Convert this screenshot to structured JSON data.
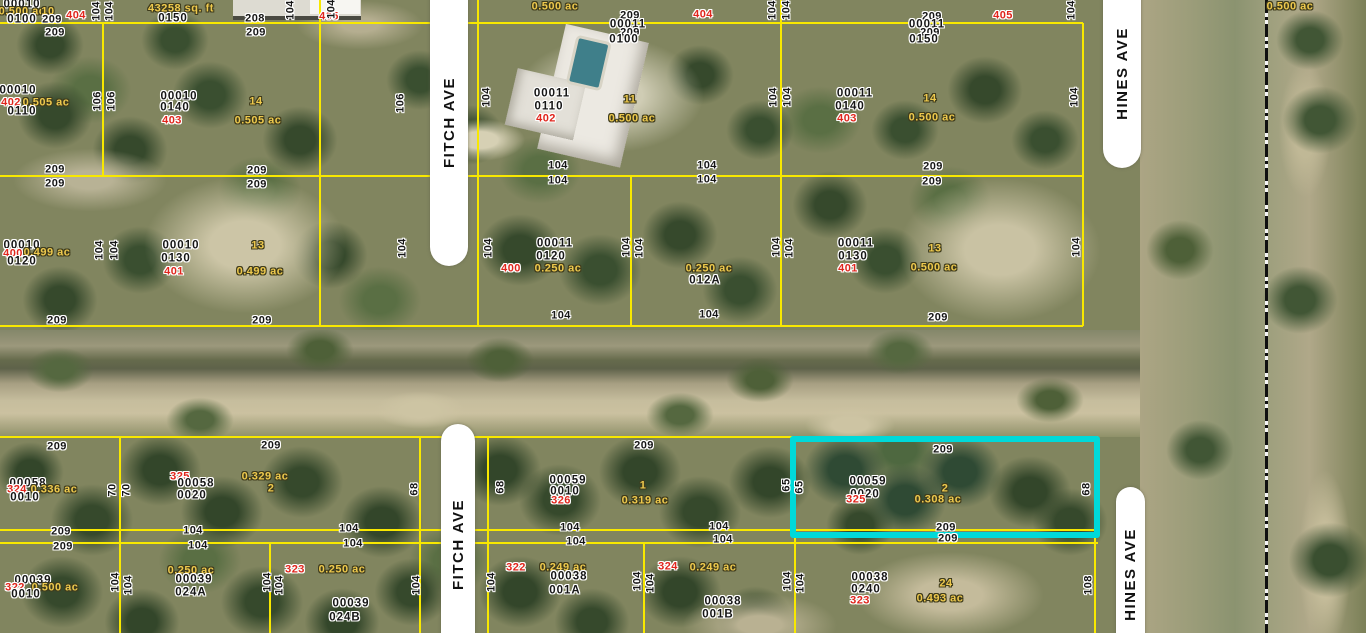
{
  "roads": [
    {
      "label": "FITCH AVE"
    },
    {
      "label": "FITCH AVE"
    },
    {
      "label": "HINES AVE"
    },
    {
      "label": "HINES AVE"
    }
  ],
  "colors": {
    "parcel_line": "#f8e800",
    "highlight": "#00d9d9",
    "house_number_text": "#e0251c",
    "lot_area_text": "#eec94d",
    "parcel_id_text": "#161616",
    "road_fill": "#ffffff"
  },
  "highlighted_parcel": {
    "parcel_id": "00059 0020",
    "lot": "2",
    "area": "0.308 ac",
    "house_number": "325",
    "frontage": "209",
    "depth": "65"
  },
  "labels": [
    [
      "00010",
      "pid",
      22,
      5,
      0
    ],
    [
      "0.500 ac",
      "yel",
      22,
      12,
      0
    ],
    [
      "10",
      "yel",
      48,
      12,
      0
    ],
    [
      "0100",
      "pid",
      22,
      20,
      0
    ],
    [
      "209",
      "dim",
      52,
      20,
      0
    ],
    [
      "404",
      "red",
      76,
      16,
      0
    ],
    [
      "104",
      "dim",
      97,
      11,
      1
    ],
    [
      "104",
      "dim",
      110,
      11,
      1
    ],
    [
      "43258 sq. ft",
      "yel",
      181,
      9,
      0
    ],
    [
      "0150",
      "pid",
      173,
      19,
      0
    ],
    [
      "208",
      "dim",
      255,
      19,
      0
    ],
    [
      "405",
      "red",
      329,
      17,
      0
    ],
    [
      "104",
      "dim",
      291,
      10,
      1
    ],
    [
      "104",
      "dim",
      332,
      9,
      1
    ],
    [
      "0.500 ac",
      "yel",
      555,
      7,
      0
    ],
    [
      "209",
      "dim",
      630,
      16,
      0
    ],
    [
      "00011",
      "pid",
      628,
      25,
      0
    ],
    [
      "209",
      "dim",
      630,
      33,
      0
    ],
    [
      "0100",
      "pid",
      624,
      40,
      0
    ],
    [
      "404",
      "red",
      703,
      15,
      0
    ],
    [
      "104",
      "dim",
      773,
      10,
      1
    ],
    [
      "104",
      "dim",
      787,
      10,
      1
    ],
    [
      "209",
      "dim",
      932,
      17,
      0
    ],
    [
      "00011",
      "pid",
      927,
      25,
      0
    ],
    [
      "209",
      "dim",
      930,
      33,
      0
    ],
    [
      "0150",
      "pid",
      924,
      40,
      0
    ],
    [
      "405",
      "red",
      1003,
      16,
      0
    ],
    [
      "104",
      "dim",
      1072,
      10,
      1
    ],
    [
      "0.500 ac",
      "yel",
      1290,
      7,
      0
    ],
    [
      "209",
      "dim",
      55,
      33,
      0
    ],
    [
      "209",
      "dim",
      256,
      33,
      0
    ],
    [
      "00010",
      "pid",
      18,
      91,
      0
    ],
    [
      "402",
      "red",
      11,
      103,
      0
    ],
    [
      "0.505 ac",
      "yel",
      46,
      103,
      0
    ],
    [
      "0110",
      "pid",
      22,
      112,
      0
    ],
    [
      "106",
      "dim",
      98,
      101,
      1
    ],
    [
      "106",
      "dim",
      112,
      101,
      1
    ],
    [
      "00010",
      "pid",
      179,
      97,
      0
    ],
    [
      "0140",
      "pid",
      175,
      108,
      0
    ],
    [
      "403",
      "red",
      172,
      121,
      0
    ],
    [
      "14",
      "yel",
      256,
      102,
      0
    ],
    [
      "0.505 ac",
      "yel",
      258,
      121,
      0
    ],
    [
      "106",
      "dim",
      401,
      103,
      1
    ],
    [
      "104",
      "dim",
      487,
      97,
      1
    ],
    [
      "00011",
      "pid",
      552,
      94,
      0
    ],
    [
      "0110",
      "pid",
      549,
      107,
      0
    ],
    [
      "402",
      "red",
      546,
      119,
      0
    ],
    [
      "11",
      "yel",
      630,
      100,
      0
    ],
    [
      "0.500 ac",
      "yel",
      632,
      119,
      0
    ],
    [
      "104",
      "dim",
      774,
      97,
      1
    ],
    [
      "104",
      "dim",
      788,
      97,
      1
    ],
    [
      "00011",
      "pid",
      855,
      94,
      0
    ],
    [
      "0140",
      "pid",
      850,
      107,
      0
    ],
    [
      "403",
      "red",
      847,
      119,
      0
    ],
    [
      "14",
      "yel",
      930,
      99,
      0
    ],
    [
      "0.500 ac",
      "yel",
      932,
      118,
      0
    ],
    [
      "104",
      "dim",
      1075,
      97,
      1
    ],
    [
      "209",
      "dim",
      55,
      170,
      0
    ],
    [
      "209",
      "dim",
      55,
      184,
      0
    ],
    [
      "209",
      "dim",
      257,
      171,
      0
    ],
    [
      "209",
      "dim",
      257,
      185,
      0
    ],
    [
      "104",
      "dim",
      558,
      166,
      0
    ],
    [
      "104",
      "dim",
      558,
      181,
      0
    ],
    [
      "104",
      "dim",
      707,
      166,
      0
    ],
    [
      "104",
      "dim",
      707,
      180,
      0
    ],
    [
      "209",
      "dim",
      933,
      167,
      0
    ],
    [
      "209",
      "dim",
      932,
      182,
      0
    ],
    [
      "00010",
      "pid",
      22,
      246,
      0
    ],
    [
      "400",
      "red",
      13,
      254,
      0
    ],
    [
      "0.499 ac",
      "yel",
      47,
      253,
      0
    ],
    [
      "0120",
      "pid",
      22,
      262,
      0
    ],
    [
      "104",
      "dim",
      100,
      250,
      1
    ],
    [
      "104",
      "dim",
      115,
      250,
      1
    ],
    [
      "00010",
      "pid",
      181,
      246,
      0
    ],
    [
      "0130",
      "pid",
      176,
      259,
      0
    ],
    [
      "401",
      "red",
      174,
      272,
      0
    ],
    [
      "13",
      "yel",
      258,
      246,
      0
    ],
    [
      "0.499 ac",
      "yel",
      260,
      272,
      0
    ],
    [
      "104",
      "dim",
      403,
      248,
      1
    ],
    [
      "104",
      "dim",
      489,
      248,
      1
    ],
    [
      "00011",
      "pid",
      555,
      244,
      0
    ],
    [
      "0120",
      "pid",
      551,
      257,
      0
    ],
    [
      "400",
      "red",
      511,
      269,
      0
    ],
    [
      "0.250 ac",
      "yel",
      558,
      269,
      0
    ],
    [
      "104",
      "dim",
      627,
      247,
      1
    ],
    [
      "104",
      "dim",
      640,
      248,
      1
    ],
    [
      "0.250 ac",
      "yel",
      709,
      269,
      0
    ],
    [
      "012A",
      "pid",
      705,
      281,
      0
    ],
    [
      "104",
      "dim",
      777,
      247,
      1
    ],
    [
      "104",
      "dim",
      790,
      248,
      1
    ],
    [
      "00011",
      "pid",
      856,
      244,
      0
    ],
    [
      "0130",
      "pid",
      853,
      257,
      0
    ],
    [
      "401",
      "red",
      848,
      269,
      0
    ],
    [
      "13",
      "yel",
      935,
      249,
      0
    ],
    [
      "0.500 ac",
      "yel",
      934,
      268,
      0
    ],
    [
      "104",
      "dim",
      1077,
      247,
      1
    ],
    [
      "209",
      "dim",
      57,
      321,
      0
    ],
    [
      "209",
      "dim",
      262,
      321,
      0
    ],
    [
      "104",
      "dim",
      561,
      316,
      0
    ],
    [
      "104",
      "dim",
      709,
      315,
      0
    ],
    [
      "209",
      "dim",
      938,
      318,
      0
    ],
    [
      "209",
      "dim",
      57,
      447,
      0
    ],
    [
      "209",
      "dim",
      271,
      446,
      0
    ],
    [
      "209",
      "dim",
      644,
      446,
      0
    ],
    [
      "209",
      "dim",
      943,
      450,
      0
    ],
    [
      "00058",
      "pid",
      28,
      484,
      0
    ],
    [
      "324",
      "red",
      17,
      490,
      0
    ],
    [
      "0.336 ac",
      "yel",
      54,
      490,
      0
    ],
    [
      "0010",
      "pid",
      25,
      498,
      0
    ],
    [
      "70",
      "dim",
      113,
      490,
      1
    ],
    [
      "70",
      "dim",
      127,
      490,
      1
    ],
    [
      "325",
      "red",
      180,
      477,
      0
    ],
    [
      "00058",
      "pid",
      196,
      484,
      0
    ],
    [
      "0020",
      "pid",
      192,
      496,
      0
    ],
    [
      "0.329 ac",
      "yel",
      265,
      477,
      0
    ],
    [
      "2",
      "yel",
      271,
      489,
      0
    ],
    [
      "68",
      "dim",
      415,
      489,
      1
    ],
    [
      "68",
      "dim",
      501,
      487,
      1
    ],
    [
      "00059",
      "pid",
      568,
      481,
      0
    ],
    [
      "0010",
      "pid",
      565,
      492,
      0
    ],
    [
      "326",
      "red",
      561,
      501,
      0
    ],
    [
      "1",
      "yel",
      643,
      486,
      0
    ],
    [
      "0.319 ac",
      "yel",
      645,
      501,
      0
    ],
    [
      "65",
      "dim",
      787,
      485,
      1
    ],
    [
      "65",
      "dim",
      800,
      487,
      1
    ],
    [
      "00059",
      "pid",
      868,
      482,
      0
    ],
    [
      "0020",
      "pid",
      865,
      495,
      0
    ],
    [
      "325",
      "red",
      856,
      500,
      0
    ],
    [
      "2",
      "yel",
      945,
      489,
      0
    ],
    [
      "0.308 ac",
      "yel",
      938,
      500,
      0
    ],
    [
      "68",
      "dim",
      1087,
      489,
      1
    ],
    [
      "209",
      "dim",
      61,
      532,
      0
    ],
    [
      "209",
      "dim",
      63,
      547,
      0
    ],
    [
      "104",
      "dim",
      193,
      531,
      0
    ],
    [
      "104",
      "dim",
      198,
      546,
      0
    ],
    [
      "104",
      "dim",
      349,
      529,
      0
    ],
    [
      "104",
      "dim",
      353,
      544,
      0
    ],
    [
      "104",
      "dim",
      570,
      528,
      0
    ],
    [
      "104",
      "dim",
      576,
      542,
      0
    ],
    [
      "104",
      "dim",
      719,
      527,
      0
    ],
    [
      "104",
      "dim",
      723,
      540,
      0
    ],
    [
      "209",
      "dim",
      946,
      528,
      0
    ],
    [
      "209",
      "dim",
      948,
      539,
      0
    ],
    [
      "00039",
      "pid",
      33,
      581,
      0
    ],
    [
      "322",
      "red",
      15,
      588,
      0
    ],
    [
      "0.500 ac",
      "yel",
      55,
      588,
      0
    ],
    [
      "0010",
      "pid",
      26,
      595,
      0
    ],
    [
      "104",
      "dim",
      116,
      582,
      1
    ],
    [
      "104",
      "dim",
      129,
      585,
      1
    ],
    [
      "0.250 ac",
      "yel",
      191,
      571,
      0
    ],
    [
      "00039",
      "pid",
      194,
      580,
      0
    ],
    [
      "024A",
      "pid",
      191,
      593,
      0
    ],
    [
      "104",
      "dim",
      268,
      582,
      1
    ],
    [
      "104",
      "dim",
      280,
      585,
      1
    ],
    [
      "323",
      "red",
      295,
      570,
      0
    ],
    [
      "0.250 ac",
      "yel",
      342,
      570,
      0
    ],
    [
      "00039",
      "pid",
      351,
      604,
      0
    ],
    [
      "024B",
      "pid",
      345,
      618,
      0
    ],
    [
      "104",
      "dim",
      417,
      585,
      1
    ],
    [
      "322",
      "red",
      516,
      568,
      0
    ],
    [
      "0.249 ac",
      "yel",
      563,
      568,
      0
    ],
    [
      "00038",
      "pid",
      569,
      577,
      0
    ],
    [
      "001A",
      "pid",
      565,
      591,
      0
    ],
    [
      "104",
      "dim",
      492,
      582,
      1
    ],
    [
      "104",
      "dim",
      638,
      581,
      1
    ],
    [
      "104",
      "dim",
      651,
      583,
      1
    ],
    [
      "324",
      "red",
      668,
      567,
      0
    ],
    [
      "0.249 ac",
      "yel",
      713,
      568,
      0
    ],
    [
      "00038",
      "pid",
      723,
      602,
      0
    ],
    [
      "001B",
      "pid",
      718,
      615,
      0
    ],
    [
      "104",
      "dim",
      788,
      581,
      1
    ],
    [
      "104",
      "dim",
      801,
      583,
      1
    ],
    [
      "00038",
      "pid",
      870,
      578,
      0
    ],
    [
      "0240",
      "pid",
      866,
      590,
      0
    ],
    [
      "323",
      "red",
      860,
      601,
      0
    ],
    [
      "24",
      "yel",
      946,
      584,
      0
    ],
    [
      "0.493 ac",
      "yel",
      940,
      599,
      0
    ],
    [
      "108",
      "dim",
      1089,
      585,
      1
    ]
  ]
}
